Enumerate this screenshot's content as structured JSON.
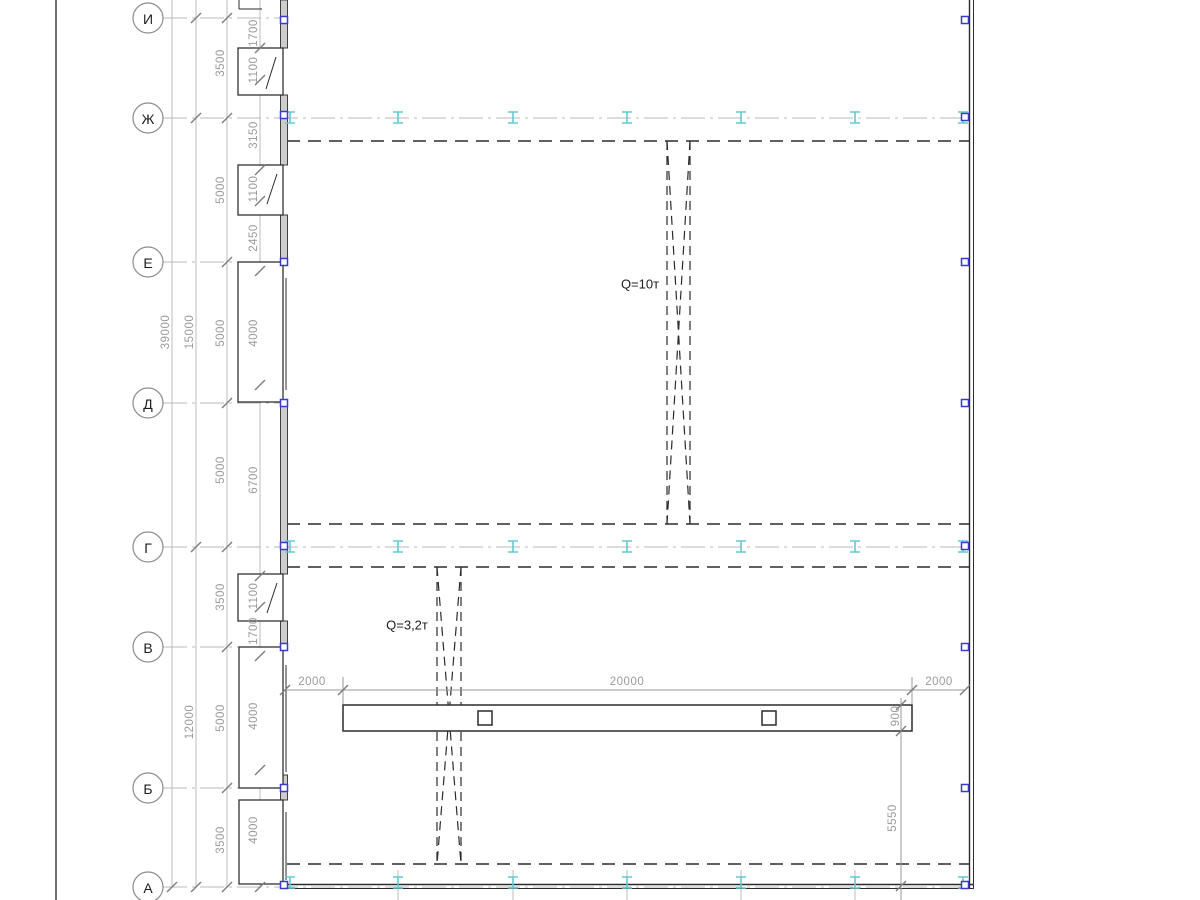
{
  "meta": {
    "type": "building-plan-drawing"
  },
  "colors": {
    "line": "#2b2b2b",
    "centerline": "#b9b9b9",
    "dimension": "#9a9a9a",
    "crane_rail_marker": "#64c8d4",
    "column_marker": "#3a3acc"
  },
  "axes": [
    {
      "label": "И",
      "y": 18,
      "full": false
    },
    {
      "label": "Ж",
      "y": 118,
      "full": true
    },
    {
      "label": "Е",
      "y": 262,
      "full": false
    },
    {
      "label": "Д",
      "y": 403,
      "full": false
    },
    {
      "label": "Г",
      "y": 547,
      "full": true
    },
    {
      "label": "В",
      "y": 647,
      "full": false
    },
    {
      "label": "Б",
      "y": 788,
      "full": false
    },
    {
      "label": "А",
      "y": 887,
      "full": true
    }
  ],
  "dim_labels": [
    {
      "text": "39000",
      "x": 166,
      "y": 332,
      "rot": true
    },
    {
      "text": "15000",
      "x": 190,
      "y": 332,
      "rot": true
    },
    {
      "text": "12000",
      "x": 190,
      "y": 722,
      "rot": true
    },
    {
      "text": "3500",
      "x": 221,
      "y": 63,
      "rot": true
    },
    {
      "text": "5000",
      "x": 221,
      "y": 190,
      "rot": true
    },
    {
      "text": "5000",
      "x": 221,
      "y": 333,
      "rot": true
    },
    {
      "text": "5000",
      "x": 221,
      "y": 470,
      "rot": true
    },
    {
      "text": "3500",
      "x": 221,
      "y": 597,
      "rot": true
    },
    {
      "text": "5000",
      "x": 221,
      "y": 718,
      "rot": true
    },
    {
      "text": "3500",
      "x": 221,
      "y": 840,
      "rot": true
    },
    {
      "text": "1700",
      "x": 254,
      "y": 33,
      "rot": true
    },
    {
      "text": "1100",
      "x": 254,
      "y": 70,
      "rot": true
    },
    {
      "text": "3150",
      "x": 254,
      "y": 135,
      "rot": true
    },
    {
      "text": "1100",
      "x": 254,
      "y": 189,
      "rot": true
    },
    {
      "text": "2450",
      "x": 254,
      "y": 238,
      "rot": true
    },
    {
      "text": "4000",
      "x": 254,
      "y": 333,
      "rot": true
    },
    {
      "text": "6700",
      "x": 254,
      "y": 480,
      "rot": true
    },
    {
      "text": "1100",
      "x": 254,
      "y": 596,
      "rot": true
    },
    {
      "text": "1700",
      "x": 254,
      "y": 631,
      "rot": true
    },
    {
      "text": "4000",
      "x": 254,
      "y": 716,
      "rot": true
    },
    {
      "text": "4000",
      "x": 254,
      "y": 830,
      "rot": true
    },
    {
      "text": "2000",
      "x": 312,
      "y": 682,
      "rot": false
    },
    {
      "text": "20000",
      "x": 627,
      "y": 682,
      "rot": false
    },
    {
      "text": "2000",
      "x": 939,
      "y": 682,
      "rot": false
    },
    {
      "text": "900",
      "x": 896,
      "y": 716,
      "rot": true
    },
    {
      "text": "5550",
      "x": 893,
      "y": 818,
      "rot": true
    }
  ],
  "cranes": [
    {
      "label": "Q=10т",
      "x": 640,
      "y": 284
    },
    {
      "label": "Q=3,2т",
      "x": 407,
      "y": 625
    }
  ],
  "markers": {
    "rail_rows": [
      {
        "y": 117,
        "xs": [
          290,
          398,
          513,
          627,
          741,
          855,
          963
        ]
      },
      {
        "y": 546,
        "xs": [
          290,
          398,
          513,
          627,
          741,
          855,
          963
        ]
      },
      {
        "y": 882,
        "xs": [
          290,
          398,
          513,
          627,
          741,
          855,
          963
        ]
      }
    ],
    "columns_left": {
      "x": 284,
      "ys": [
        20,
        115,
        262,
        403,
        546,
        647,
        788,
        885
      ]
    },
    "columns_right": {
      "x": 965,
      "ys": [
        20,
        117,
        262,
        403,
        546,
        647,
        788,
        885
      ]
    }
  }
}
